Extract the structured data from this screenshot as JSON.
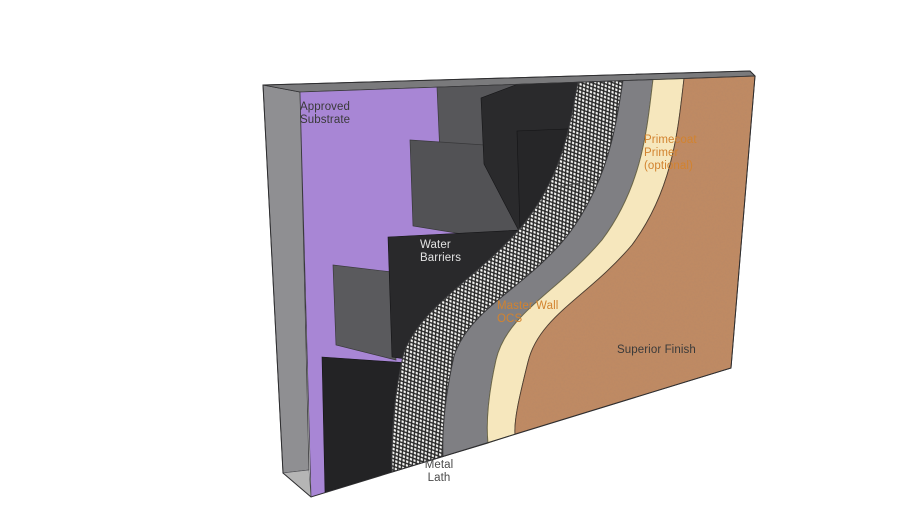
{
  "diagram": {
    "title": "Wall assembly cutaway (one-coat stucco system)",
    "labels": {
      "approved_substrate": "Approved\nSubstrate",
      "water_barriers": "Water\nBarriers",
      "master_wall_ocs": "Master Wall\nOCS",
      "primecoat_primer": "Primecoat\nPrimer\n(optional)",
      "superior_finish": "Superior Finish",
      "metal_lath": "Metal\nLath"
    },
    "colors": {
      "background": "#ffffff",
      "substrate": "#a886d5",
      "barrier_gray_1": "#57575a",
      "barrier_gray_2": "#525255",
      "barrier_gray_3": "#5a5a5d",
      "barrier_black_1": "#2a2a2c",
      "barrier_black_2": "#262628",
      "barrier_black_3": "#29292b",
      "barrier_black_4": "#232325",
      "lath_bg": "#f6f6f4",
      "lath_line": "#262626",
      "basecoat": "#7f7f83",
      "primer": "#f6e7bd",
      "finish": "#c28b63",
      "side_face": "#8f8f92",
      "top_cap": "#7a7a7c",
      "bottom_face": "#b5b5b5",
      "label_dark": "#3a3a3a",
      "label_light": "#e2e2e2",
      "label_orange": "#d2832f"
    }
  }
}
